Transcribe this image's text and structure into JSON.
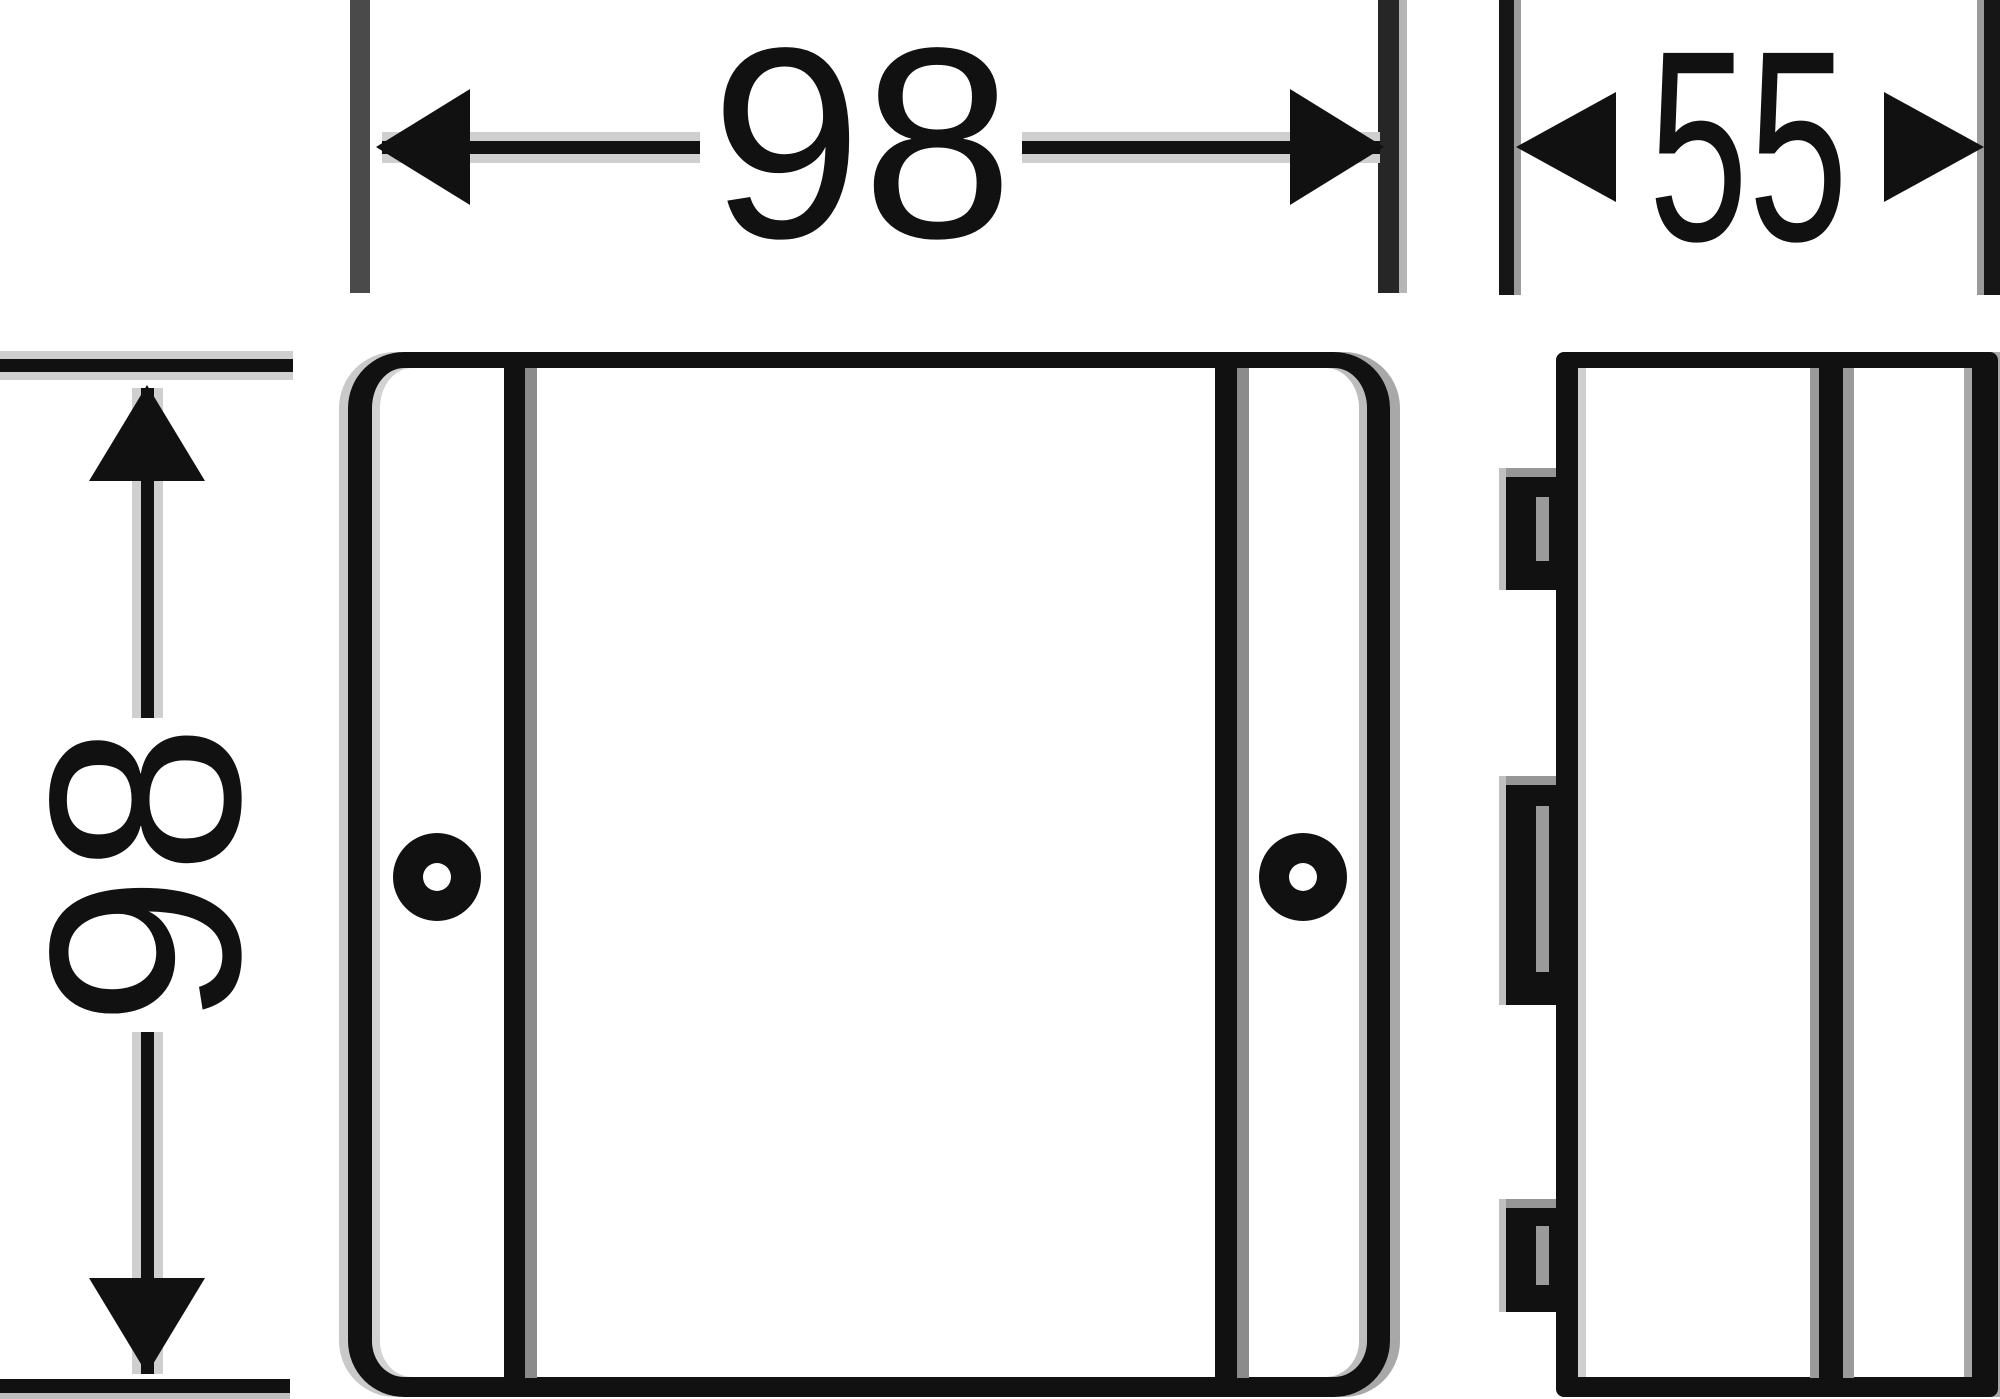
{
  "diagram": {
    "type": "technical-drawing",
    "dimensions": {
      "front_width": {
        "value": "98"
      },
      "front_height": {
        "value": "98"
      },
      "side_depth": {
        "value": "55"
      }
    },
    "colors": {
      "line": "#111111",
      "background": "#ffffff",
      "extension_gray": "#4a4a4a",
      "halo_gray": "#cfcfcf",
      "fringe_gray": "#9e9e9e"
    }
  }
}
